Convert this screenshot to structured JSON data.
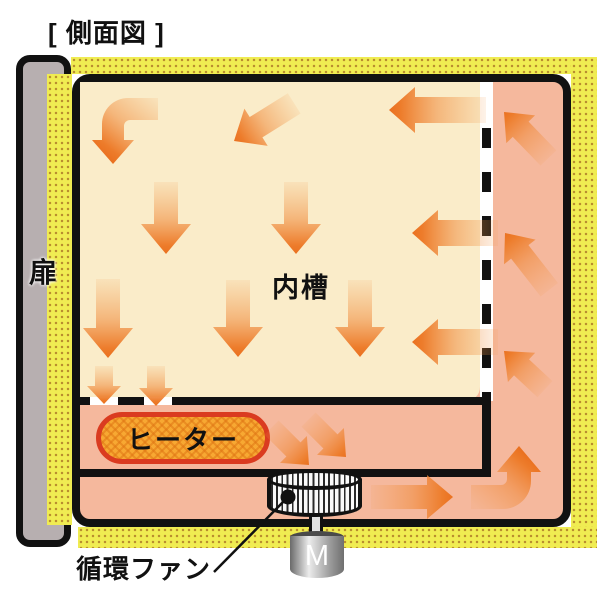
{
  "title": "[ 側面図 ]",
  "labels": {
    "door": "扉",
    "inner_chamber": "内槽",
    "heater": "ヒーター",
    "fan": "循環ファン",
    "motor": "M"
  },
  "colors": {
    "insulation_yellow": "#F0EC52",
    "insulation_dot": "#B98E2F",
    "plenum_salmon": "#F5B89D",
    "chamber_cream": "#FAECC9",
    "outline_black": "#111111",
    "arrow_orange": "#ED7C2B",
    "heater_fill": "#F7A832",
    "heater_border": "#DA3B20",
    "door_gray": "#B7AFB0"
  },
  "diagram": {
    "arrows": [
      {
        "name": "top-diagonal-downleft",
        "tip": [
          234,
          141
        ],
        "angle": 148,
        "len": 71,
        "sw": 24,
        "hw": 44,
        "hl": 26
      },
      {
        "name": "top-right-left",
        "tip": [
          389,
          110
        ],
        "angle": 180,
        "len": 97,
        "sw": 26,
        "hw": 46,
        "hl": 26
      },
      {
        "name": "mid-down-1",
        "tip": [
          166,
          254
        ],
        "angle": 90,
        "len": 72,
        "sw": 24,
        "hw": 50,
        "hl": 30
      },
      {
        "name": "mid-down-2",
        "tip": [
          296,
          254
        ],
        "angle": 90,
        "len": 72,
        "sw": 24,
        "hw": 50,
        "hl": 30
      },
      {
        "name": "mid-right-left",
        "tip": [
          412,
          233
        ],
        "angle": 180,
        "len": 86,
        "sw": 26,
        "hw": 46,
        "hl": 26
      },
      {
        "name": "low-down-1",
        "tip": [
          108,
          358
        ],
        "angle": 90,
        "len": 79,
        "sw": 24,
        "hw": 50,
        "hl": 30
      },
      {
        "name": "low-down-2",
        "tip": [
          238,
          357
        ],
        "angle": 90,
        "len": 77,
        "sw": 24,
        "hw": 50,
        "hl": 30
      },
      {
        "name": "low-down-3",
        "tip": [
          360,
          357
        ],
        "angle": 90,
        "len": 77,
        "sw": 24,
        "hw": 50,
        "hl": 30
      },
      {
        "name": "low-right-left",
        "tip": [
          412,
          342
        ],
        "angle": 180,
        "len": 86,
        "sw": 26,
        "hw": 46,
        "hl": 26
      },
      {
        "name": "outlet-down-1",
        "tip": [
          104,
          404
        ],
        "angle": 90,
        "len": 38,
        "sw": 18,
        "hw": 34,
        "hl": 18
      },
      {
        "name": "outlet-down-2",
        "tip": [
          156,
          406
        ],
        "angle": 90,
        "len": 40,
        "sw": 18,
        "hw": 34,
        "hl": 18
      },
      {
        "name": "to-fan-1",
        "tip": [
          309,
          465
        ],
        "angle": 45,
        "len": 53,
        "sw": 20,
        "hw": 38,
        "hl": 22
      },
      {
        "name": "to-fan-2",
        "tip": [
          346,
          457
        ],
        "angle": 45,
        "len": 53,
        "sw": 20,
        "hw": 38,
        "hl": 22
      },
      {
        "name": "fan-out-right",
        "tip": [
          453,
          497
        ],
        "angle": 0,
        "len": 82,
        "sw": 24,
        "hw": 44,
        "hl": 26
      },
      {
        "name": "duct-up-1",
        "tip": [
          504,
          112
        ],
        "angle": -134,
        "len": 64,
        "sw": 22,
        "hw": 40,
        "hl": 24
      },
      {
        "name": "duct-up-2",
        "tip": [
          505,
          233
        ],
        "angle": -128,
        "len": 72,
        "sw": 22,
        "hw": 40,
        "hl": 24
      },
      {
        "name": "duct-up-3",
        "tip": [
          504,
          351
        ],
        "angle": -137,
        "len": 56,
        "sw": 22,
        "hw": 40,
        "hl": 24
      }
    ],
    "elbow_arrows": [
      {
        "name": "top-left-elbow-down",
        "d": "M 158,98 L 128,98 A 26 26 0 0 0 102,124 L 102,140 L 92,140 L 113,164 L 134,140 L 124,140 L 124,126 A 6 6 0 0 1 130,120 L 158,120 Z",
        "grad": "ag1"
      },
      {
        "name": "bottom-right-elbow-up",
        "d": "M 471,509 L 503,509 A 28 28 0 0 0 531,481 L 531,472 L 541,472 L 519,446 L 497,472 L 507,472 L 507,479 A 6 6 0 0 1 501,485 L 471,485 Z",
        "grad": "ag2"
      }
    ],
    "fan_leader": {
      "dot": [
        288,
        497
      ],
      "from": [
        286,
        499
      ],
      "to": [
        214,
        572
      ]
    }
  }
}
